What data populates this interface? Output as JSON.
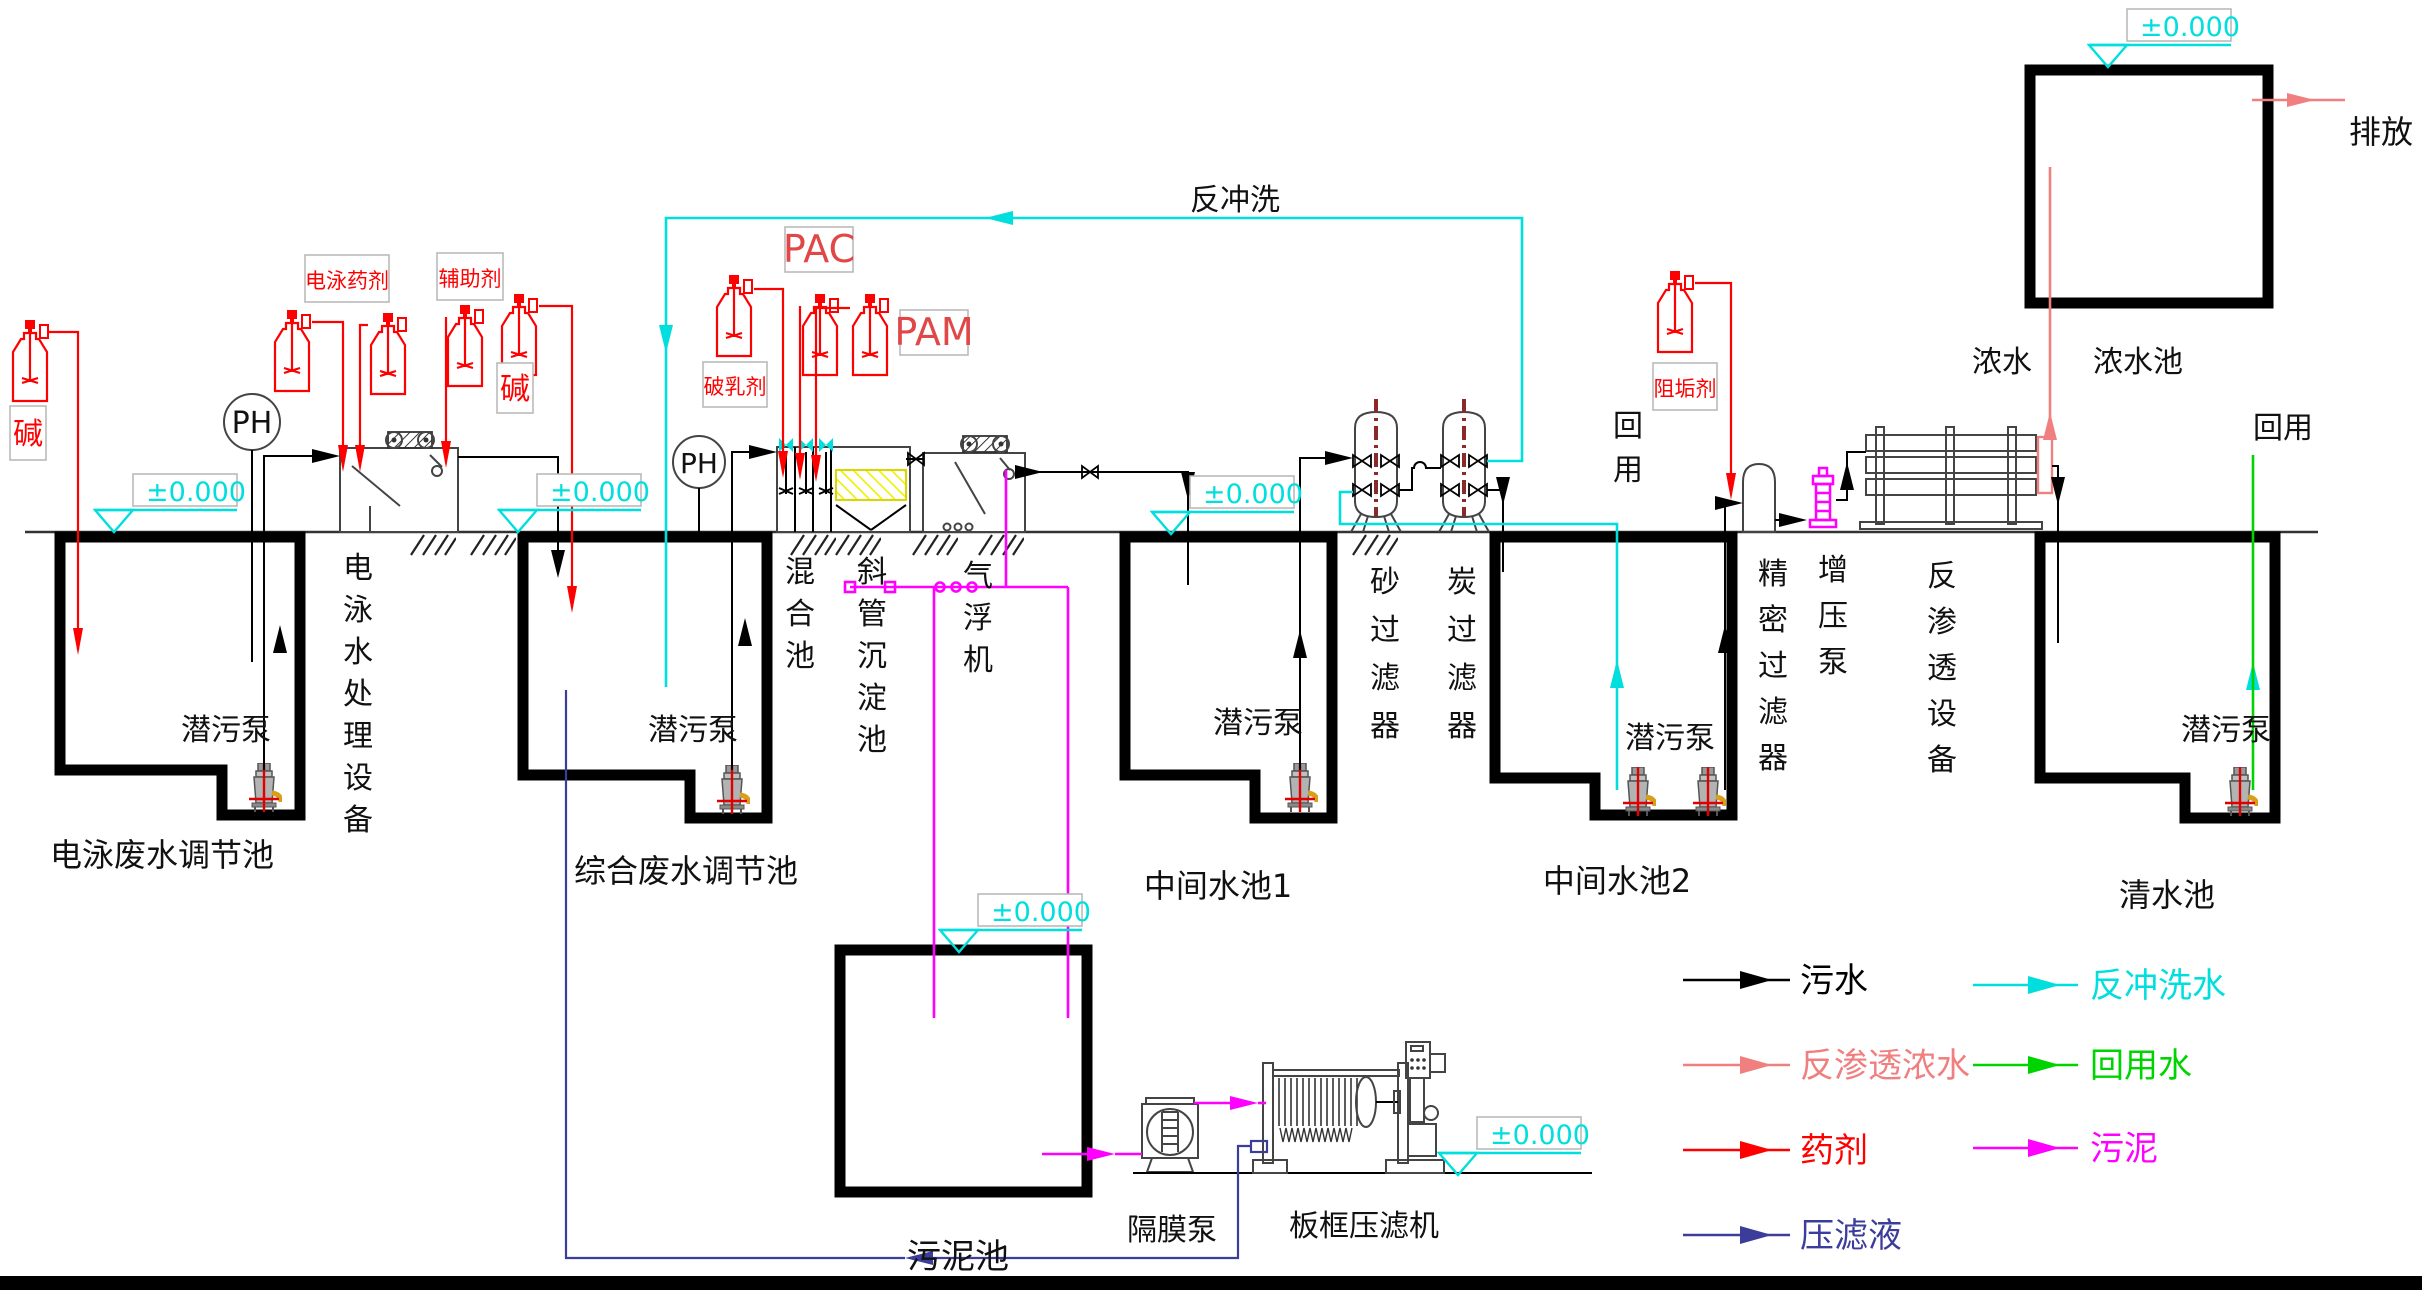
{
  "diagram": {
    "backwash_header": "反冲洗",
    "discharge": "排放",
    "concentrate": "浓水",
    "reuse_top": "回用",
    "reuse_side": "回用",
    "level_marker": "±0.000",
    "ph": "PH"
  },
  "chemicals": {
    "alkali1": "碱",
    "alkali2": "碱",
    "ep_agent": "电泳药剂",
    "auxiliary": "辅助剂",
    "demulsifier": "破乳剂",
    "pac": "PAC",
    "pam": "PAM",
    "antiscalant": "阻垢剂"
  },
  "pools": {
    "ep_adjust": "电泳废水调节池",
    "comprehensive_adjust": "综合废水调节池",
    "middle1": "中间水池1",
    "middle2": "中间水池2",
    "clean": "清水池",
    "concentrate_pool": "浓水池",
    "sludge": "污泥池"
  },
  "equipment": {
    "ep_treatment": "电泳水处理设备",
    "mixing": "混合池",
    "settler": "斜管沉淀池",
    "daf": "气浮机",
    "sand_filter": "砂过滤器",
    "carbon_filter": "炭过滤器",
    "precision_filter": "精密过滤器",
    "booster_pump": "增压泵",
    "ro_unit": "反渗透设备",
    "submersible_pump": "潜污泵",
    "diaphragm_pump": "隔膜泵",
    "filter_press": "板框压滤机"
  },
  "legend": {
    "left": [
      {
        "label": "污水",
        "color": "#000000"
      },
      {
        "label": "反渗透浓水",
        "color": "#f08080"
      },
      {
        "label": "药剂",
        "color": "#ff0000"
      },
      {
        "label": "压滤液",
        "color": "#3c3c9b"
      }
    ],
    "right": [
      {
        "label": "反冲洗水",
        "color": "#00dede"
      },
      {
        "label": "回用水",
        "color": "#00d400"
      },
      {
        "label": "污泥",
        "color": "#ff00ff"
      }
    ]
  },
  "colors": {
    "sewage": "#000000",
    "backwash": "#00dede",
    "ro_concentrate": "#f08080",
    "reuse_water": "#00d400",
    "chemical": "#ff0000",
    "sludge": "#ff00ff",
    "press_filtrate": "#3c3c9b",
    "level_mark": "#00dede",
    "settler_tubes": "#ffff00",
    "filter_center_pipe": "#8b2a2a"
  }
}
